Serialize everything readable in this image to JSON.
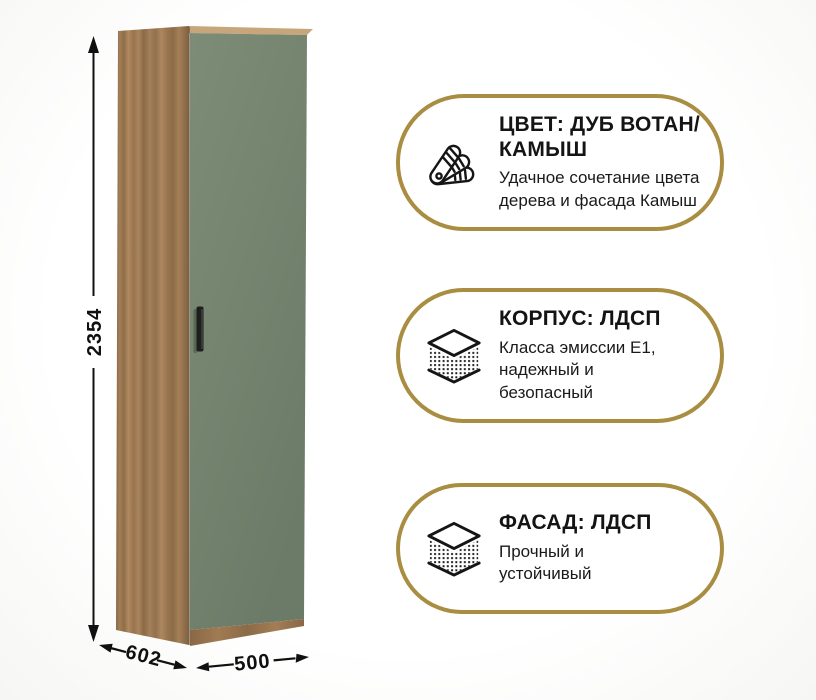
{
  "product": {
    "dimensions": {
      "height": "2354",
      "depth": "602",
      "width": "500"
    }
  },
  "badges": [
    {
      "icon": "color-swatch-fan-icon",
      "title": "ЦВЕТ: ДУБ ВОТАН/\nКАМЫШ",
      "subtitle": "Удачное сочетание цвета\nдерева и фасада Камыш"
    },
    {
      "icon": "layered-board-icon",
      "title": "КОРПУС: ЛДСП",
      "subtitle": "Класса эмиссии Е1,\nнадежный и\nбезопасный"
    },
    {
      "icon": "layered-board-icon",
      "title": "ФАСАД: ЛДСП",
      "subtitle": "Прочный и\nустойчивый"
    }
  ],
  "colors": {
    "accent_gold": "#a98e42",
    "door_green": "#75846f",
    "wood_brown": "#9c7851",
    "line_black": "#101010",
    "background": "#ffffff"
  }
}
